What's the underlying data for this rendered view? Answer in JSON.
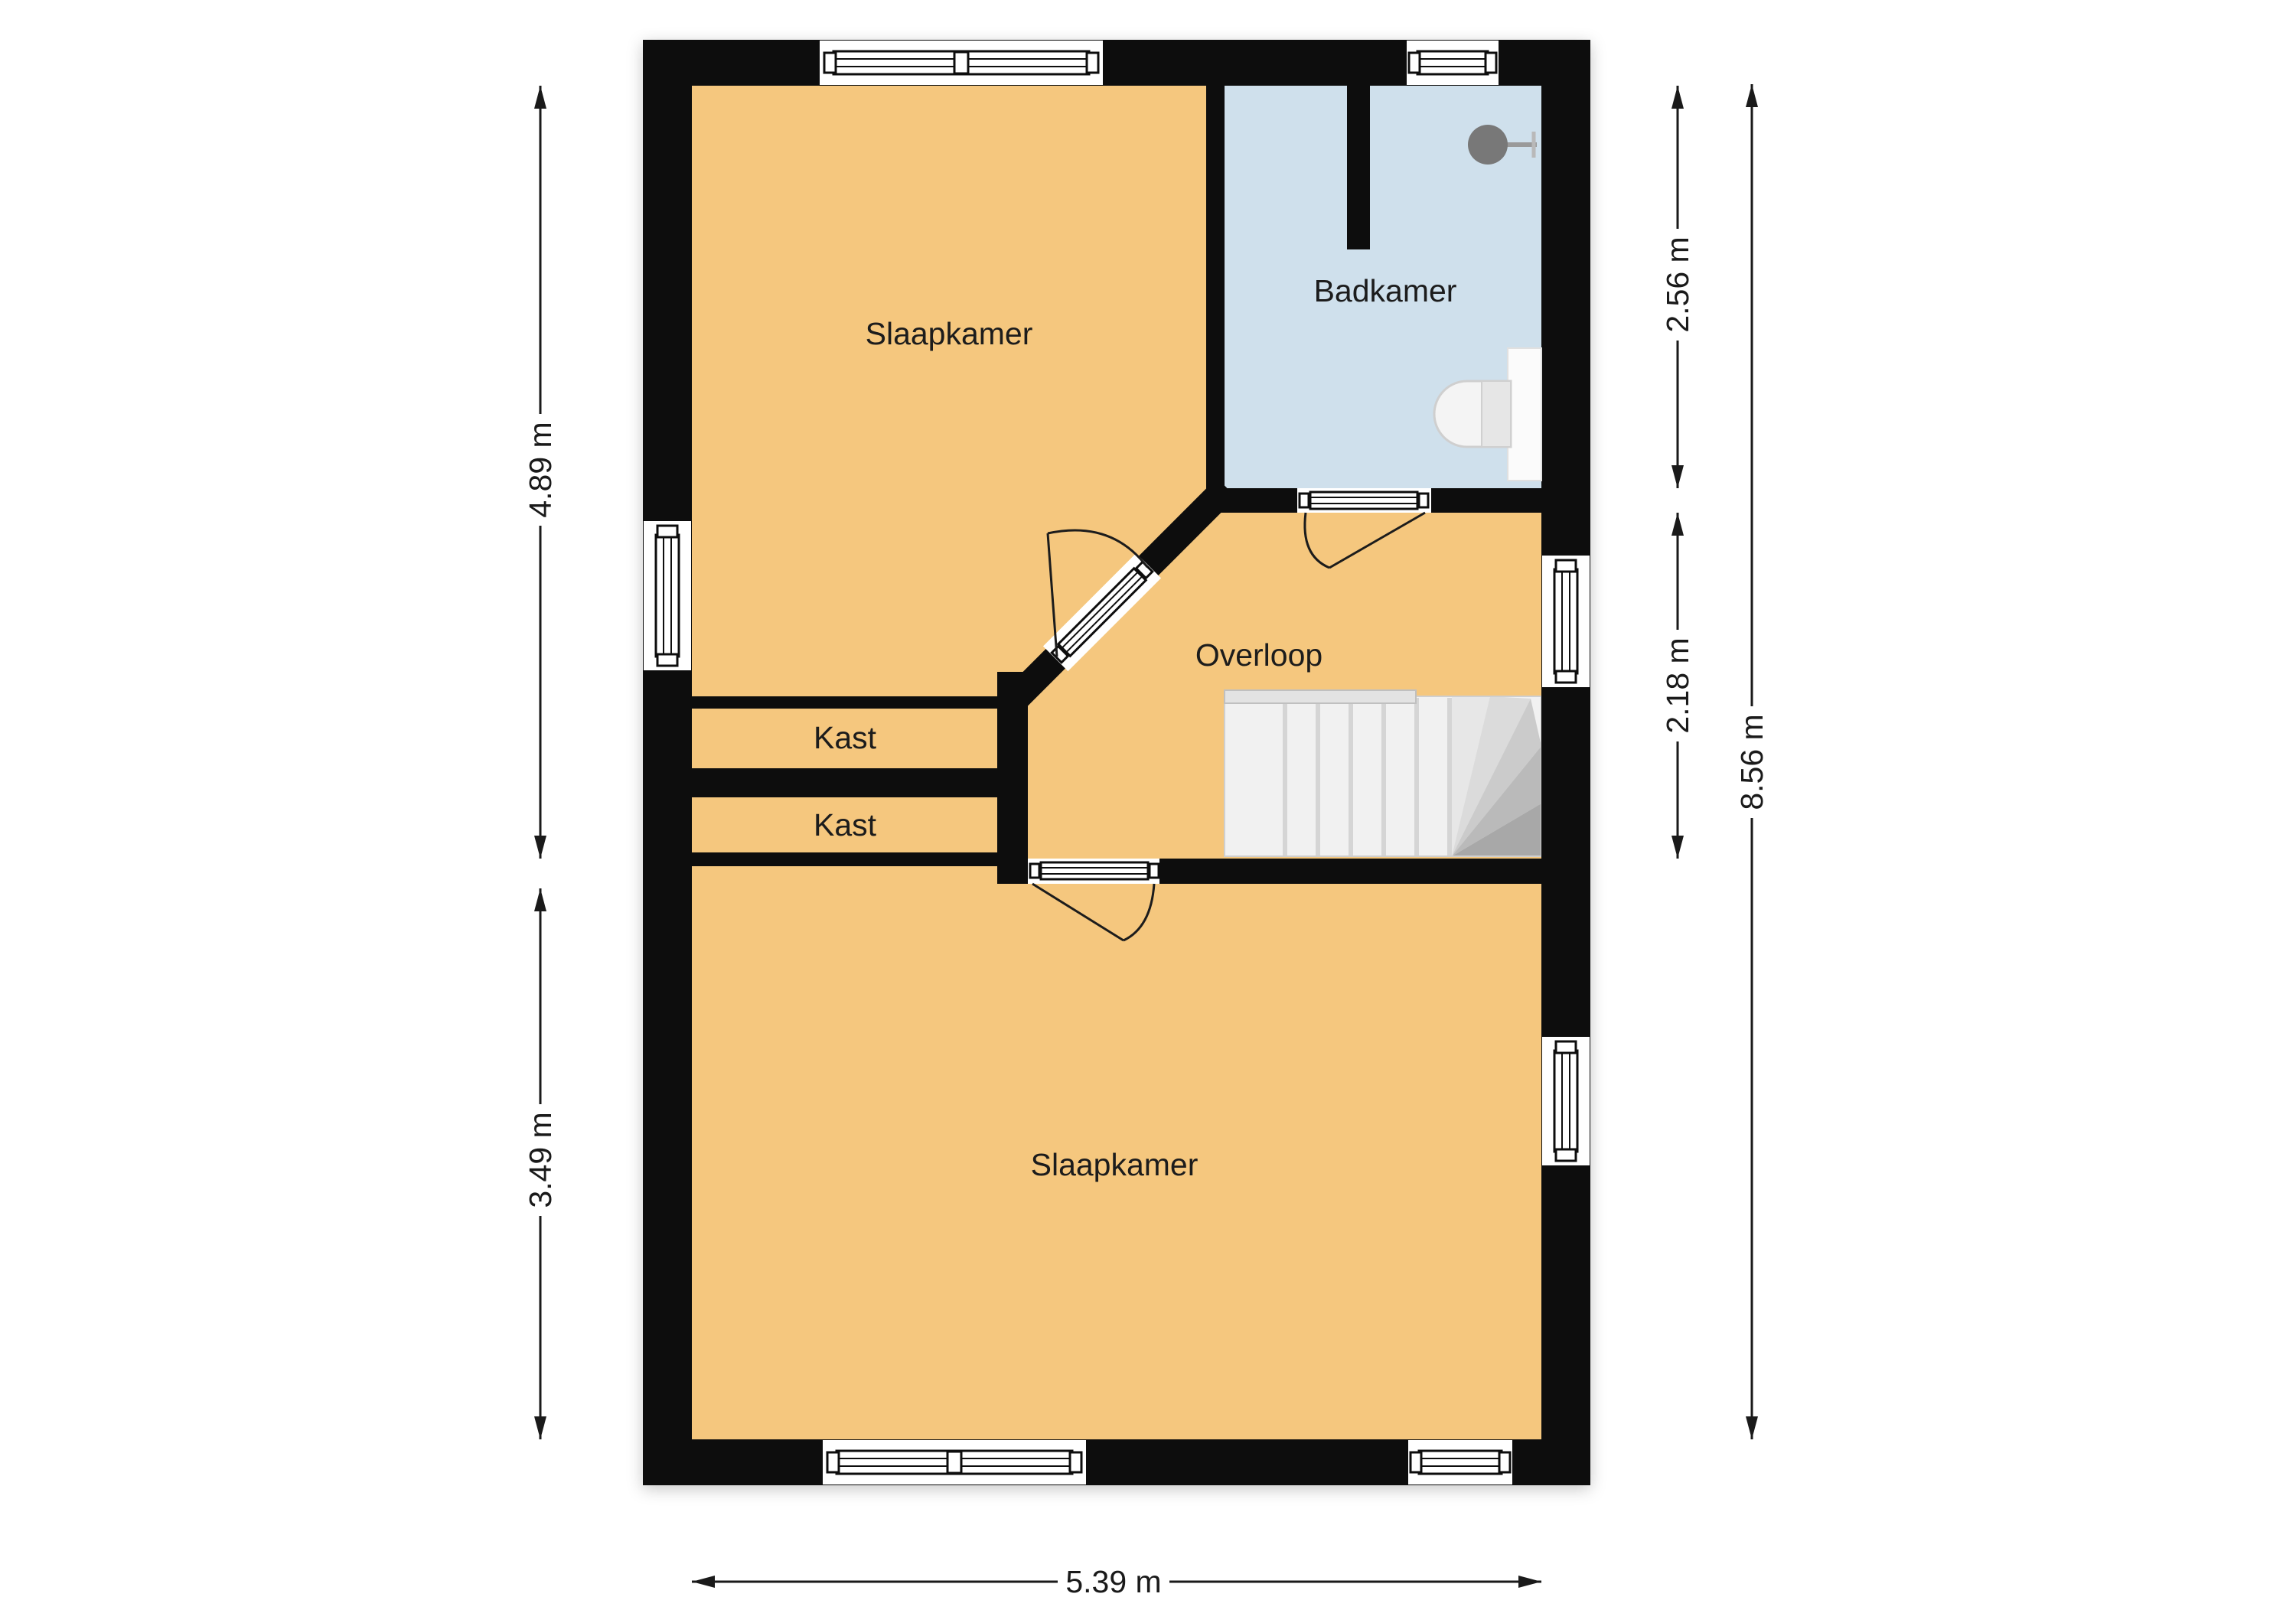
{
  "floorplan": {
    "rooms": [
      {
        "id": "slaapkamer-top",
        "label": "Slaapkamer"
      },
      {
        "id": "badkamer",
        "label": "Badkamer"
      },
      {
        "id": "overloop",
        "label": "Overloop"
      },
      {
        "id": "kast-upper",
        "label": "Kast"
      },
      {
        "id": "kast-lower",
        "label": "Kast"
      },
      {
        "id": "slaapkamer-bottom",
        "label": "Slaapkamer"
      }
    ],
    "dimensions": {
      "left_upper": "4.89 m",
      "left_lower": "3.49 m",
      "right_upper": "2.56 m",
      "right_middle": "2.18 m",
      "right_total": "8.56 m",
      "bottom": "5.39 m"
    },
    "fixtures": [
      {
        "id": "shower",
        "icon": "shower-head-icon"
      },
      {
        "id": "toilet",
        "icon": "toilet-icon"
      },
      {
        "id": "staircase",
        "icon": "stairs-icon"
      }
    ],
    "colors": {
      "wall": "#0d0d0d",
      "room": "#f5c77e",
      "bathroom": "#cfe0ec",
      "stairs": "#f1f1f1",
      "text": "#1a1a1a"
    }
  }
}
